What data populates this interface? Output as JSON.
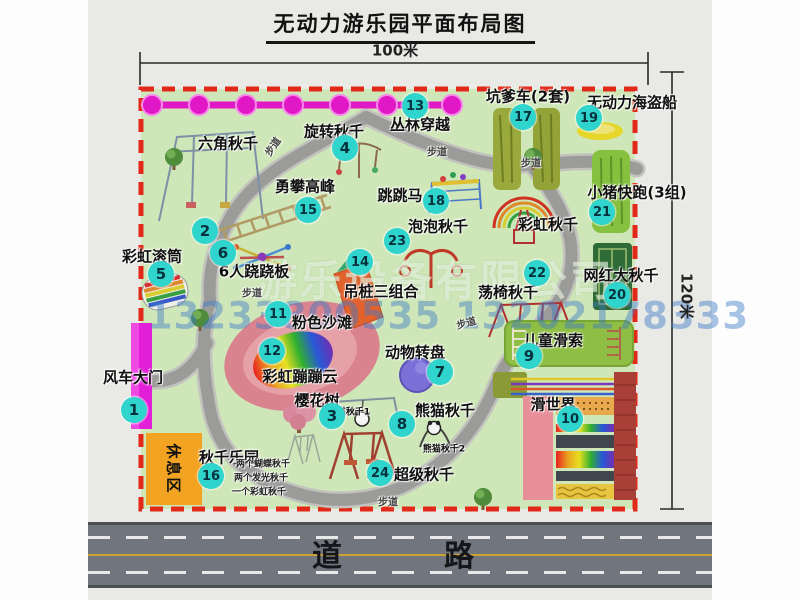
{
  "title": "无动力游乐园平面布局图",
  "scale": {
    "top": "100米",
    "right": "120米"
  },
  "road_label": "道　　路",
  "rest_area_label": "休息区",
  "watermark": {
    "company": "游乐设备有限公司",
    "phone": "13233800535 13202178333"
  },
  "colors": {
    "park_green": "#cfe7b8",
    "border_red": "#e22818",
    "badge_cyan": "#2fd4cc",
    "chain_magenta": "#e118c6",
    "gate_magenta": "#e31ed8",
    "rest_orange": "#f2a322",
    "road_gray": "#71757d",
    "path_gray": "#9b9b99",
    "beach_pink": "#d8838e"
  },
  "attractions": [
    {
      "num": "1",
      "name": "风车大门",
      "badge": [
        134,
        410
      ],
      "label": [
        133,
        377
      ]
    },
    {
      "num": "2",
      "name": "六角秋千",
      "badge": [
        205,
        231
      ],
      "label": [
        228,
        143
      ]
    },
    {
      "num": "3",
      "name": "樱花树",
      "badge": [
        332,
        416
      ],
      "label": [
        317,
        400
      ]
    },
    {
      "num": "4",
      "name": "旋转秋千",
      "badge": [
        345,
        148
      ],
      "label": [
        334,
        131
      ]
    },
    {
      "num": "5",
      "name": "彩虹滚筒",
      "badge": [
        161,
        274
      ],
      "label": [
        152,
        256
      ]
    },
    {
      "num": "6",
      "name": "6人跷跷板",
      "badge": [
        223,
        253
      ],
      "label": [
        254,
        271
      ]
    },
    {
      "num": "7",
      "name": "动物转盘",
      "badge": [
        440,
        372
      ],
      "label": [
        415,
        352
      ]
    },
    {
      "num": "8",
      "name": "熊猫秋千",
      "badge": [
        402,
        424
      ],
      "label": [
        445,
        410
      ]
    },
    {
      "num": "9",
      "name": "儿童滑索",
      "badge": [
        529,
        356
      ],
      "label": [
        553,
        340
      ]
    },
    {
      "num": "10",
      "name": "滑世界",
      "badge": [
        570,
        419
      ],
      "label": [
        553,
        404
      ]
    },
    {
      "num": "11",
      "name": "粉色沙滩",
      "badge": [
        278,
        314
      ],
      "label": [
        322,
        322
      ]
    },
    {
      "num": "12",
      "name": "彩虹蹦蹦云",
      "badge": [
        272,
        351
      ],
      "label": [
        300,
        376
      ]
    },
    {
      "num": "13",
      "name": "丛林穿越",
      "badge": [
        415,
        106
      ],
      "label": [
        420,
        124
      ]
    },
    {
      "num": "14",
      "name": "吊桩三组合",
      "badge": [
        360,
        262
      ],
      "label": [
        381,
        291
      ]
    },
    {
      "num": "15",
      "name": "勇攀高峰",
      "badge": [
        308,
        210
      ],
      "label": [
        305,
        186
      ]
    },
    {
      "num": "16",
      "name": "秋千乐园",
      "badge": [
        211,
        476
      ],
      "label": [
        229,
        457
      ]
    },
    {
      "num": "17",
      "name": "坑爹车(2套)",
      "badge": [
        523,
        117
      ],
      "label": [
        528,
        96
      ]
    },
    {
      "num": "18",
      "name": "跳跳马",
      "badge": [
        436,
        201
      ],
      "label": [
        400,
        195
      ]
    },
    {
      "num": "19",
      "name": "无动力海盗船",
      "badge": [
        589,
        118
      ],
      "label": [
        632,
        102
      ]
    },
    {
      "num": "20",
      "name": "网红大秋千",
      "badge": [
        617,
        295
      ],
      "label": [
        621,
        275
      ]
    },
    {
      "num": "21",
      "name": "小猪快跑(3组)",
      "badge": [
        602,
        212
      ],
      "label": [
        637,
        192
      ]
    },
    {
      "num": "22",
      "name": "荡椅秋千",
      "badge": [
        537,
        273
      ],
      "label": [
        508,
        292
      ]
    },
    {
      "num": "23",
      "name": "泡泡秋千",
      "badge": [
        397,
        241
      ],
      "label": [
        438,
        226
      ]
    },
    {
      "num": "24",
      "name": "超级秋千",
      "badge": [
        380,
        473
      ],
      "label": [
        424,
        474
      ]
    }
  ],
  "map_labels": [
    {
      "text": "彩虹秋千",
      "x": 548,
      "y": 224,
      "size": 15,
      "rot": 0,
      "cls": "attr"
    },
    {
      "text": "熊猫秋千1",
      "x": 349,
      "y": 411,
      "size": 9,
      "rot": 0,
      "cls": "attr"
    },
    {
      "text": "熊猫秋千2",
      "x": 444,
      "y": 448,
      "size": 9,
      "rot": 0,
      "cls": "attr"
    },
    {
      "text": "两个蝴蝶秋千",
      "x": 263,
      "y": 463,
      "size": 9,
      "rot": 0,
      "cls": "note"
    },
    {
      "text": "两个发光秋千",
      "x": 261,
      "y": 477,
      "size": 9,
      "rot": 0,
      "cls": "note"
    },
    {
      "text": "一个彩虹秋千",
      "x": 259,
      "y": 491,
      "size": 9,
      "rot": 0,
      "cls": "note"
    },
    {
      "text": "步道",
      "x": 437,
      "y": 151,
      "size": 10,
      "rot": 0,
      "cls": "path"
    },
    {
      "text": "步道",
      "x": 272,
      "y": 146,
      "size": 10,
      "rot": -55,
      "cls": "path"
    },
    {
      "text": "步道",
      "x": 531,
      "y": 162,
      "size": 10,
      "rot": 0,
      "cls": "path"
    },
    {
      "text": "步道",
      "x": 252,
      "y": 292,
      "size": 10,
      "rot": 0,
      "cls": "path"
    },
    {
      "text": "步道",
      "x": 466,
      "y": 322,
      "size": 10,
      "rot": -15,
      "cls": "path"
    },
    {
      "text": "步道",
      "x": 388,
      "y": 501,
      "size": 10,
      "rot": 0,
      "cls": "path"
    }
  ]
}
